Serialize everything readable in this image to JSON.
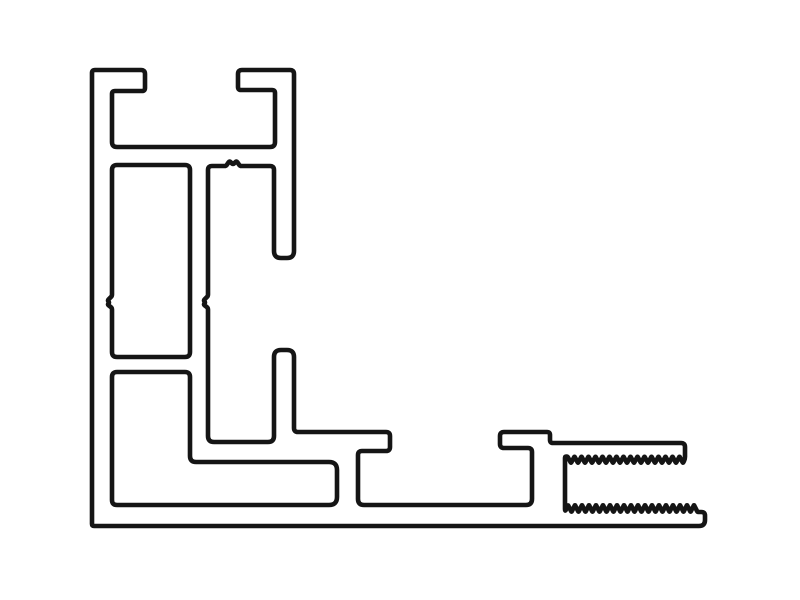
{
  "canvas": {
    "width": 800,
    "height": 600,
    "background_color": "#ffffff"
  },
  "profile_drawing": {
    "stroke": {
      "color": "#151515",
      "width": 4.6
    },
    "paths": [
      {
        "name": "profile-outer-silhouette",
        "closed": true,
        "points": [
          [
            92,
            70,
            3
          ],
          [
            145,
            70,
            4
          ],
          [
            145,
            91,
            3
          ],
          [
            112,
            91,
            3
          ],
          [
            112,
            147,
            5
          ],
          [
            275,
            147,
            5
          ],
          [
            275,
            90,
            3
          ],
          [
            238,
            90,
            3
          ],
          [
            238,
            70,
            4
          ],
          [
            294,
            70,
            4
          ],
          [
            294,
            258,
            7
          ],
          [
            274,
            258,
            7
          ],
          [
            274,
            166,
            4
          ],
          [
            240,
            166,
            1.5
          ],
          [
            236.5,
            161,
            1.5
          ],
          [
            233,
            164.5,
            1.5
          ],
          [
            229.5,
            161,
            1.5
          ],
          [
            226,
            166,
            1.5
          ],
          [
            208,
            166,
            4
          ],
          [
            208,
            296,
            1.5
          ],
          [
            203.5,
            300.5,
            1.5
          ],
          [
            205.5,
            302.5,
            1.5
          ],
          [
            203.5,
            304.5,
            1.5
          ],
          [
            208,
            308,
            1.5
          ],
          [
            208,
            442,
            6
          ],
          [
            274,
            442,
            6
          ],
          [
            274,
            350,
            7
          ],
          [
            294,
            350,
            7
          ],
          [
            294,
            432,
            4
          ],
          [
            390,
            432,
            4
          ],
          [
            390,
            451,
            4
          ],
          [
            358,
            451,
            4
          ],
          [
            358,
            505,
            6
          ],
          [
            532,
            505,
            6
          ],
          [
            532,
            448,
            4
          ],
          [
            500,
            448,
            4
          ],
          [
            500,
            432,
            4
          ],
          [
            550,
            432,
            3
          ],
          [
            550,
            443,
            3
          ],
          [
            685,
            443,
            4
          ],
          [
            685,
            459,
            3
          ],
          {
            "saw": [
              683,
              567.5,
              463,
              456.5,
              3.5
            ]
          },
          [
            565,
            456.5,
            3
          ],
          [
            565,
            512,
            3
          ],
          {
            "saw": [
              568,
              697.5,
              505,
              512,
              3.5
            ]
          },
          [
            705,
            512,
            6
          ],
          [
            705,
            526,
            6
          ],
          [
            92,
            526,
            2
          ]
        ]
      },
      {
        "name": "cavity-tall-rectangle",
        "closed": true,
        "points": [
          [
            112,
            165,
            5
          ],
          [
            190,
            165,
            5
          ],
          [
            190,
            357,
            5
          ],
          [
            112,
            357,
            5
          ],
          [
            112,
            308,
            1.5
          ],
          [
            107.5,
            304.5,
            1.5
          ],
          [
            109.5,
            302.5,
            1.5
          ],
          [
            107.5,
            300.5,
            1.5
          ],
          [
            112,
            296,
            1.5
          ]
        ]
      },
      {
        "name": "cavity-l-shaped",
        "closed": true,
        "points": [
          [
            112,
            372,
            5
          ],
          [
            190,
            372,
            5
          ],
          [
            190,
            462,
            6
          ],
          [
            337,
            462,
            8
          ],
          [
            337,
            505,
            8
          ],
          [
            112,
            505,
            5
          ]
        ]
      }
    ]
  }
}
